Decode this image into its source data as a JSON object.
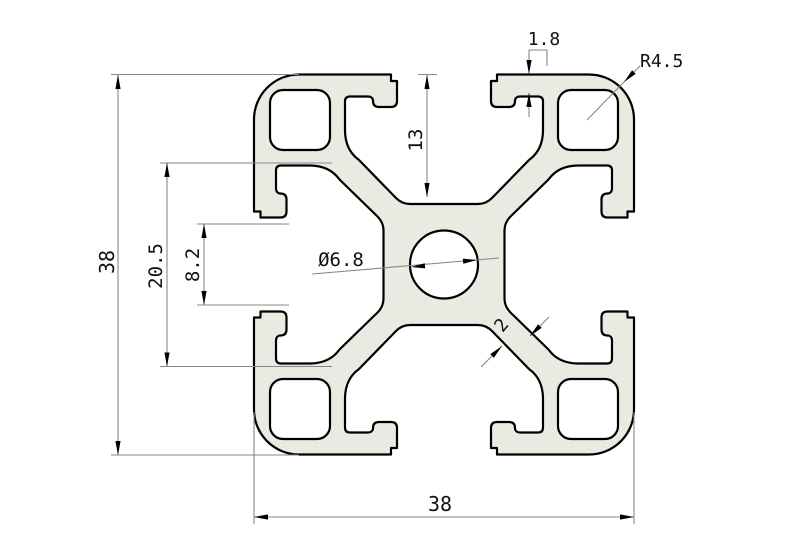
{
  "drawing": {
    "title": "aluminum-extrusion-profile-cross-section-38x38",
    "dims": {
      "lip_thickness": "1.8",
      "corner_radius": "R4.5",
      "slot_depth": "13",
      "overall_height": "38",
      "slot_shoulder_width": "20.5",
      "slot_opening_width": "8.2",
      "center_hole_diameter": "Ø6.8",
      "web_thickness": "2",
      "overall_width": "38"
    },
    "colors": {
      "profile_fill": "#e9ebe2",
      "outline": "#000000",
      "dim_lines": "#878787",
      "text": "#111111",
      "background": "#ffffff"
    }
  }
}
